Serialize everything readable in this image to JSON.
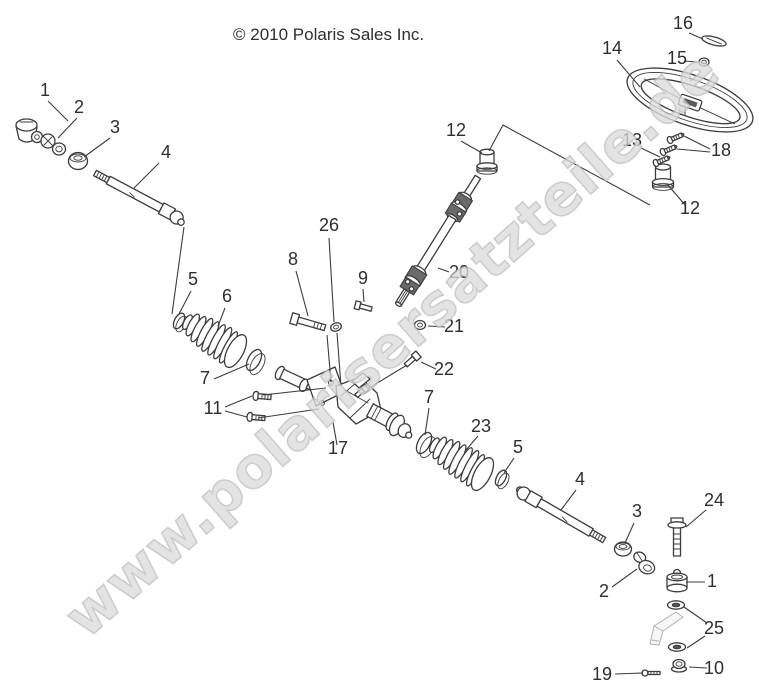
{
  "page": {
    "copyright": "© 2010 Polaris Sales Inc.",
    "watermark": "www.polarisersatzteile.de"
  },
  "diagram": {
    "callouts": [
      {
        "label": "1"
      },
      {
        "label": "2"
      },
      {
        "label": "3"
      },
      {
        "label": "4"
      },
      {
        "label": "5"
      },
      {
        "label": "6"
      },
      {
        "label": "7"
      },
      {
        "label": "8"
      },
      {
        "label": "9"
      },
      {
        "label": "11"
      },
      {
        "label": "12"
      },
      {
        "label": "13"
      },
      {
        "label": "14"
      },
      {
        "label": "15"
      },
      {
        "label": "16"
      },
      {
        "label": "17"
      },
      {
        "label": "18"
      },
      {
        "label": "20"
      },
      {
        "label": "21"
      },
      {
        "label": "22"
      },
      {
        "label": "23"
      },
      {
        "label": "7"
      },
      {
        "label": "5"
      },
      {
        "label": "4"
      },
      {
        "label": "3"
      },
      {
        "label": "24"
      },
      {
        "label": "2"
      },
      {
        "label": "1"
      },
      {
        "label": "25"
      },
      {
        "label": "12"
      },
      {
        "label": "19"
      },
      {
        "label": "10"
      },
      {
        "label": "26"
      }
    ]
  }
}
